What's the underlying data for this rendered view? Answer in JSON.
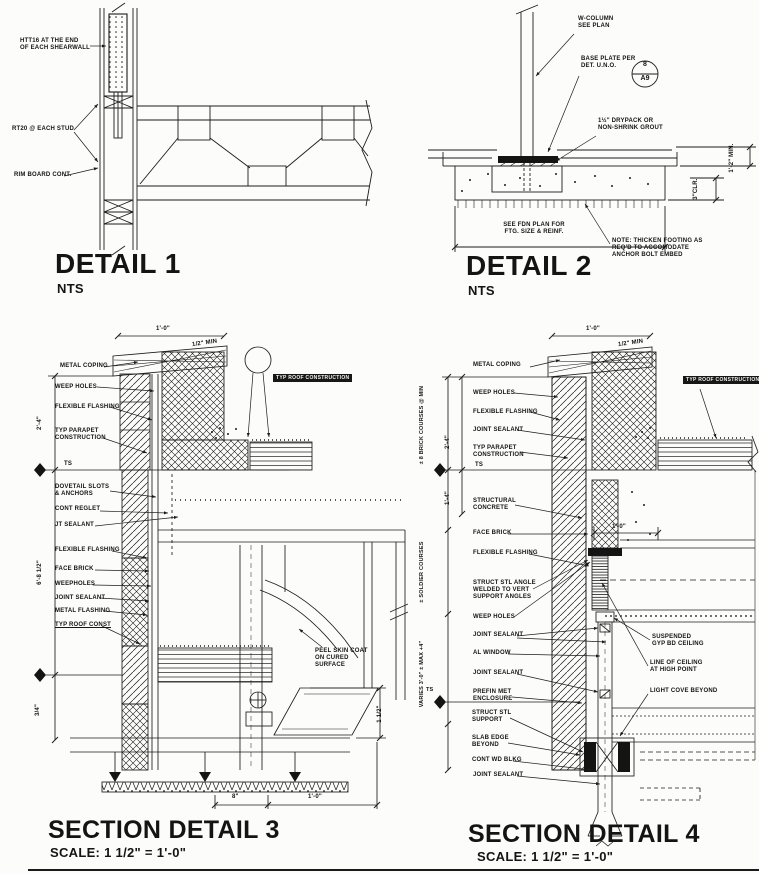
{
  "sheet": {
    "bg": "#fcfcfb",
    "ink": "#1c1c1c"
  },
  "detail1": {
    "title": "DETAIL 1",
    "scale": "NTS",
    "labels": {
      "holdown": "HTT16 AT THE END\nOF EACH SHEARWALL",
      "strap": "RT20 @ EACH STUD",
      "rim_board": "RIM BOARD CONT."
    }
  },
  "detail2": {
    "title": "DETAIL 2",
    "scale": "NTS",
    "labels": {
      "column": "W-COLUMN\nSEE PLAN",
      "base_plate": "BASE PLATE PER\nDET. U.N.O.",
      "bubble_top": "8",
      "bubble_bottom": "A9",
      "grout": "1½\" DRYPACK OR\nNON-SHRINK GROUT",
      "fdn": "SEE FDN PLAN FOR\nFTG. SIZE & REINF.",
      "note": "NOTE: THICKEN FOOTING AS\nREQ'D TO ACCOMODATE\nANCHOR BOLT EMBED",
      "dim_min": "1'-2\" MIN.",
      "dim_clr": "3\"CLR."
    }
  },
  "detail3": {
    "title": "SECTION DETAIL 3",
    "scale": "SCALE:  1 1/2\" = 1'-0\"",
    "labels": {
      "metal_coping": "METAL COPING",
      "weep_holes": "WEEP HOLES",
      "flexible_flashing_1": "FLEXIBLE FLASHING",
      "typ_parapet": "TYP PARAPET\nCONSTRUCTION",
      "ts": "TS",
      "dovetail": "DOVETAIL SLOTS\n& ANCHORS",
      "cont_reglet": "CONT REGLET",
      "jt_sealant": "JT SEALANT",
      "flexible_flashing_2": "FLEXIBLE FLASHING",
      "face_brick": "FACE BRICK",
      "weepholes": "WEEPHOLES",
      "joint_sealant": "JOINT SEALANT",
      "metal_flashing": "METAL FLASHING",
      "typ_roof_const": "TYP ROOF CONST",
      "typ_roof_construction": "TYP ROOF CONSTRUCTION",
      "peel_skin": "PEEL SKIN COAT\nON CURED\nSURFACE",
      "dim_top": "1'-0\"",
      "dim_top_min": "1/2\" MIN",
      "dim_24": "2'-4\"",
      "dim_68": "6'-8 1/2\"",
      "dim_34": "3/4\"",
      "dim_112": "1 1/2\"",
      "dim_8": "8\"",
      "dim_10": "1'-0\""
    }
  },
  "detail4": {
    "title": "SECTION DETAIL 4",
    "scale": "SCALE:  1 1/2\" = 1'-0\"",
    "labels": {
      "metal_coping": "METAL COPING",
      "weep_holes_1": "WEEP HOLES",
      "flexible_flashing_1": "FLEXIBLE FLASHING",
      "joint_sealant_1": "JOINT SEALANT",
      "typ_parapet": "TYP PARAPET\nCONSTRUCTION",
      "ts": "TS",
      "ts_2": "TS",
      "structural_concrete": "STRUCTURAL\nCONCRETE",
      "face_brick": "FACE BRICK",
      "flexible_flashing_2": "FLEXIBLE FLASHING",
      "struct_stl_angle": "STRUCT STL ANGLE\nWELDED TO VERT\nSUPPORT ANGLES",
      "weep_holes_2": "WEEP HOLES",
      "joint_sealant_2": "JOINT SEALANT",
      "al_window": "AL WINDOW",
      "joint_sealant_3": "JOINT SEALANT",
      "prefin": "PREFIN MET\nENCLOSURE",
      "struct_stl_support": "STRUCT STL\nSUPPORT",
      "slab_edge": "SLAB EDGE\nBEYOND",
      "cont_wd_blkg": "CONT WD BLKG",
      "joint_sealant_4": "JOINT SEALANT",
      "typ_roof_construction": "TYP ROOF CONSTRUCTION",
      "suspended": "SUSPENDED\nGYP BD CEILING",
      "line_of_ceiling": "LINE OF CEILING\nAT HIGH POINT",
      "light_cove": "LIGHT COVE BEYOND",
      "dim_top": "1'-0\"",
      "dim_top_min": "1/2\" MIN",
      "dim_brick_courses": "± 8 BRICK COURSES @ MIN",
      "dim_24": "2'-4\"",
      "dim_14": "1'-4\"",
      "dim_soldier": "± SOLDIER COURSES",
      "dim_varies": "VARIES 3'-0\" ± MAX +4\"",
      "dim_10": "1'-0\""
    }
  }
}
